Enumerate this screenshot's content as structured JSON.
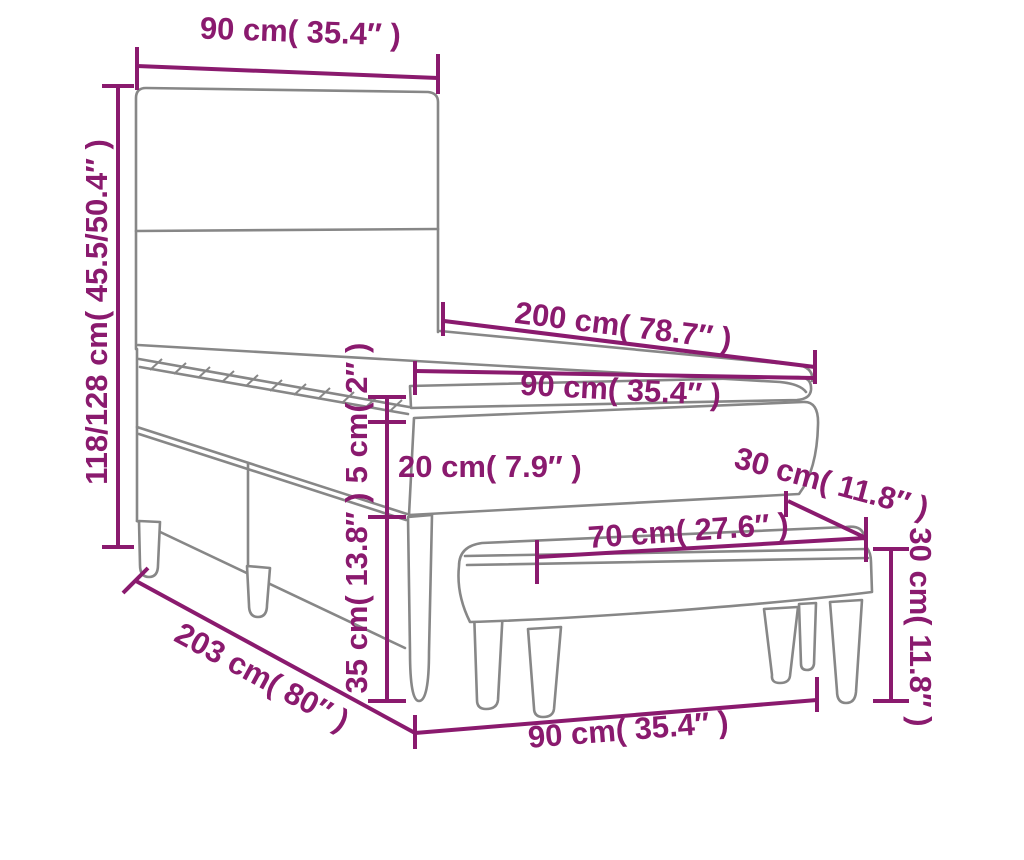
{
  "diagram": {
    "kind": "furniture-dimension-diagram",
    "objects": [
      "box-spring-bed-with-headboard",
      "bench"
    ],
    "colors": {
      "dimension": "#8A1A6E",
      "outline": "#878787",
      "background": "#FFFFFF"
    },
    "dims": {
      "headboard_width": {
        "label": "90 cm( 35.4″ )"
      },
      "height": {
        "label": "118/128 cm( 45.5/50.4″ )"
      },
      "length": {
        "label": "200 cm( 78.7″ )"
      },
      "width": {
        "label": "90 cm( 35.4″ )"
      },
      "topper_height": {
        "label": "5 cm( 2″ )"
      },
      "box_height": {
        "label": "20 cm( 7.9″ )"
      },
      "leg_height": {
        "label": "35 cm( 13.8″ )"
      },
      "total_length": {
        "label": "203 cm( 80″ )"
      },
      "bench_width": {
        "label": "90 cm( 35.4″ )"
      },
      "bench_seat_width": {
        "label": "70 cm( 27.6″ )"
      },
      "bench_depth": {
        "label": "30 cm( 11.8″ )"
      },
      "bench_height": {
        "label": "30 cm( 11.8″ )"
      }
    }
  }
}
